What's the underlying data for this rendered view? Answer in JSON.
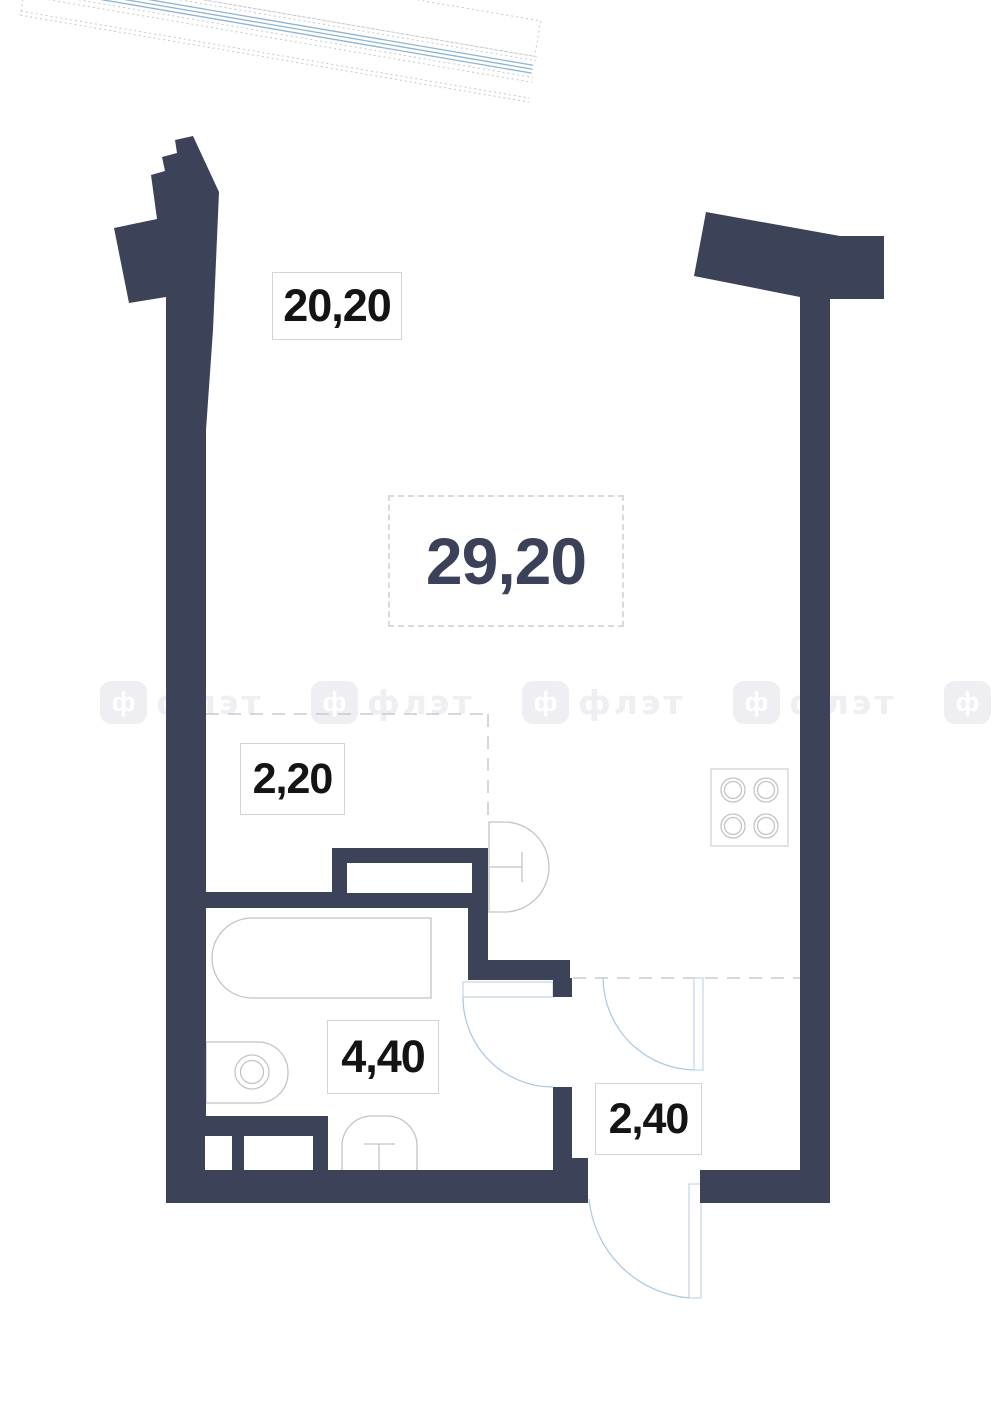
{
  "page_title": "Studio apartment floor plan",
  "total_area": {
    "value": "29,20"
  },
  "rooms": [
    {
      "key": "living-room",
      "area": "20,20"
    },
    {
      "key": "wardrobe-nook",
      "area": "2,20"
    },
    {
      "key": "bathroom",
      "area": "4,40"
    },
    {
      "key": "entry-hall",
      "area": "2,40"
    }
  ],
  "watermark": {
    "logo_glyph": "ф",
    "text": "флэт"
  },
  "fixtures": [
    "window-glazing",
    "cooktop-4-burners",
    "kitchen-sink",
    "wardrobe",
    "bathtub",
    "washbasin",
    "toilet",
    "entrance-door",
    "bathroom-door",
    "room-door"
  ],
  "colors": {
    "wall": "#3c4359",
    "window_glass": "#8fb3d4",
    "window_outline": "#c6c7cb",
    "door_arc": "#a9c6e2",
    "door_leaf_outline": "#c3d4e6",
    "fixture_outline": "#c2c4c8",
    "dashed_boundary": "#bdc0c6",
    "label_border": "#d3d4d8",
    "label_text": "#141414",
    "total_area_text": "#3a4159",
    "watermark": "#efeff3",
    "background": "#ffffff"
  }
}
